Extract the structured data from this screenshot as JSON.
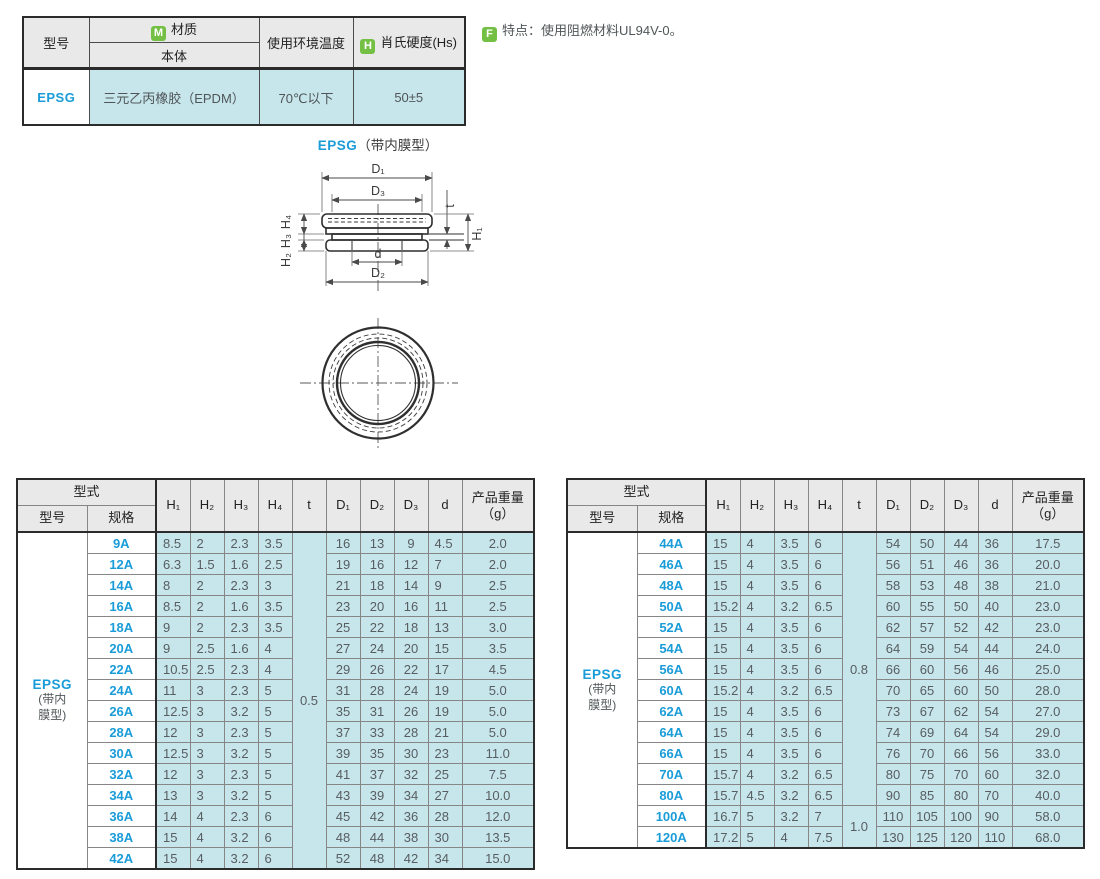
{
  "colors": {
    "accent_blue": "#1a9cd8",
    "cell_teal": "#c7e6ec",
    "header_gray": "#e9e9e9",
    "icon_green": "#74c045"
  },
  "info_table": {
    "col_model": "型号",
    "material_icon": "M",
    "col_material": "材质",
    "col_material_sub": "本体",
    "col_temp": "使用环境温度",
    "hardness_icon": "H",
    "col_hardness": "肖氏硬度(Hs)",
    "row": {
      "model": "EPSG",
      "material": "三元乙丙橡胶（EPDM）",
      "temp": "70℃以下",
      "hardness": "50±5"
    }
  },
  "feature_note": {
    "icon": "F",
    "text": "特点：使用阻燃材料UL94V-0。"
  },
  "diagram": {
    "title_model": "EPSG",
    "title_suffix": "（带内膜型）",
    "labels": {
      "d1": "D₁",
      "d2": "D₂",
      "d3": "D₃",
      "d": "d",
      "t": "t",
      "h1": "H₁",
      "h2": "H₂",
      "h3": "H₃",
      "h4": "H₄"
    }
  },
  "spec_header": {
    "group": "型式",
    "model": "型号",
    "spec": "规格",
    "h1": "H₁",
    "h2": "H₂",
    "h3": "H₃",
    "h4": "H₄",
    "t": "t",
    "d1": "D₁",
    "d2": "D₂",
    "d3": "D₃",
    "d": "d",
    "weight": "产品重量",
    "weight_unit": "（g）"
  },
  "tables": [
    {
      "model": "EPSG",
      "model_note_lines": [
        "(带内",
        "膜型)"
      ],
      "t_groups": [
        {
          "value": "0.5",
          "span": 16
        }
      ],
      "rows": [
        [
          "9A",
          "8.5",
          "2",
          "2.3",
          "3.5",
          "16",
          "13",
          "9",
          "4.5",
          "2.0"
        ],
        [
          "12A",
          "6.3",
          "1.5",
          "1.6",
          "2.5",
          "19",
          "16",
          "12",
          "7",
          "2.0"
        ],
        [
          "14A",
          "8",
          "2",
          "2.3",
          "3",
          "21",
          "18",
          "14",
          "9",
          "2.5"
        ],
        [
          "16A",
          "8.5",
          "2",
          "1.6",
          "3.5",
          "23",
          "20",
          "16",
          "11",
          "2.5"
        ],
        [
          "18A",
          "9",
          "2",
          "2.3",
          "3.5",
          "25",
          "22",
          "18",
          "13",
          "3.0"
        ],
        [
          "20A",
          "9",
          "2.5",
          "1.6",
          "4",
          "27",
          "24",
          "20",
          "15",
          "3.5"
        ],
        [
          "22A",
          "10.5",
          "2.5",
          "2.3",
          "4",
          "29",
          "26",
          "22",
          "17",
          "4.5"
        ],
        [
          "24A",
          "11",
          "3",
          "2.3",
          "5",
          "31",
          "28",
          "24",
          "19",
          "5.0"
        ],
        [
          "26A",
          "12.5",
          "3",
          "3.2",
          "5",
          "35",
          "31",
          "26",
          "19",
          "5.0"
        ],
        [
          "28A",
          "12",
          "3",
          "2.3",
          "5",
          "37",
          "33",
          "28",
          "21",
          "5.0"
        ],
        [
          "30A",
          "12.5",
          "3",
          "3.2",
          "5",
          "39",
          "35",
          "30",
          "23",
          "11.0"
        ],
        [
          "32A",
          "12",
          "3",
          "2.3",
          "5",
          "41",
          "37",
          "32",
          "25",
          "7.5"
        ],
        [
          "34A",
          "13",
          "3",
          "3.2",
          "5",
          "43",
          "39",
          "34",
          "27",
          "10.0"
        ],
        [
          "36A",
          "14",
          "4",
          "2.3",
          "6",
          "45",
          "42",
          "36",
          "28",
          "12.0"
        ],
        [
          "38A",
          "15",
          "4",
          "3.2",
          "6",
          "48",
          "44",
          "38",
          "30",
          "13.5"
        ],
        [
          "42A",
          "15",
          "4",
          "3.2",
          "6",
          "52",
          "48",
          "42",
          "34",
          "15.0"
        ]
      ]
    },
    {
      "model": "EPSG",
      "model_note_lines": [
        "(带内",
        "膜型)"
      ],
      "t_groups": [
        {
          "value": "0.8",
          "span": 13
        },
        {
          "value": "1.0",
          "span": 2
        }
      ],
      "rows": [
        [
          "44A",
          "15",
          "4",
          "3.5",
          "6",
          "54",
          "50",
          "44",
          "36",
          "17.5"
        ],
        [
          "46A",
          "15",
          "4",
          "3.5",
          "6",
          "56",
          "51",
          "46",
          "36",
          "20.0"
        ],
        [
          "48A",
          "15",
          "4",
          "3.5",
          "6",
          "58",
          "53",
          "48",
          "38",
          "21.0"
        ],
        [
          "50A",
          "15.2",
          "4",
          "3.2",
          "6.5",
          "60",
          "55",
          "50",
          "40",
          "23.0"
        ],
        [
          "52A",
          "15",
          "4",
          "3.5",
          "6",
          "62",
          "57",
          "52",
          "42",
          "23.0"
        ],
        [
          "54A",
          "15",
          "4",
          "3.5",
          "6",
          "64",
          "59",
          "54",
          "44",
          "24.0"
        ],
        [
          "56A",
          "15",
          "4",
          "3.5",
          "6",
          "66",
          "60",
          "56",
          "46",
          "25.0"
        ],
        [
          "60A",
          "15.2",
          "4",
          "3.2",
          "6.5",
          "70",
          "65",
          "60",
          "50",
          "28.0"
        ],
        [
          "62A",
          "15",
          "4",
          "3.5",
          "6",
          "73",
          "67",
          "62",
          "54",
          "27.0"
        ],
        [
          "64A",
          "15",
          "4",
          "3.5",
          "6",
          "74",
          "69",
          "64",
          "54",
          "29.0"
        ],
        [
          "66A",
          "15",
          "4",
          "3.5",
          "6",
          "76",
          "70",
          "66",
          "56",
          "33.0"
        ],
        [
          "70A",
          "15.7",
          "4",
          "3.2",
          "6.5",
          "80",
          "75",
          "70",
          "60",
          "32.0"
        ],
        [
          "80A",
          "15.7",
          "4.5",
          "3.2",
          "6.5",
          "90",
          "85",
          "80",
          "70",
          "40.0"
        ],
        [
          "100A",
          "16.7",
          "5",
          "3.2",
          "7",
          "110",
          "105",
          "100",
          "90",
          "58.0"
        ],
        [
          "120A",
          "17.2",
          "5",
          "4",
          "7.5",
          "130",
          "125",
          "120",
          "110",
          "68.0"
        ]
      ]
    }
  ]
}
